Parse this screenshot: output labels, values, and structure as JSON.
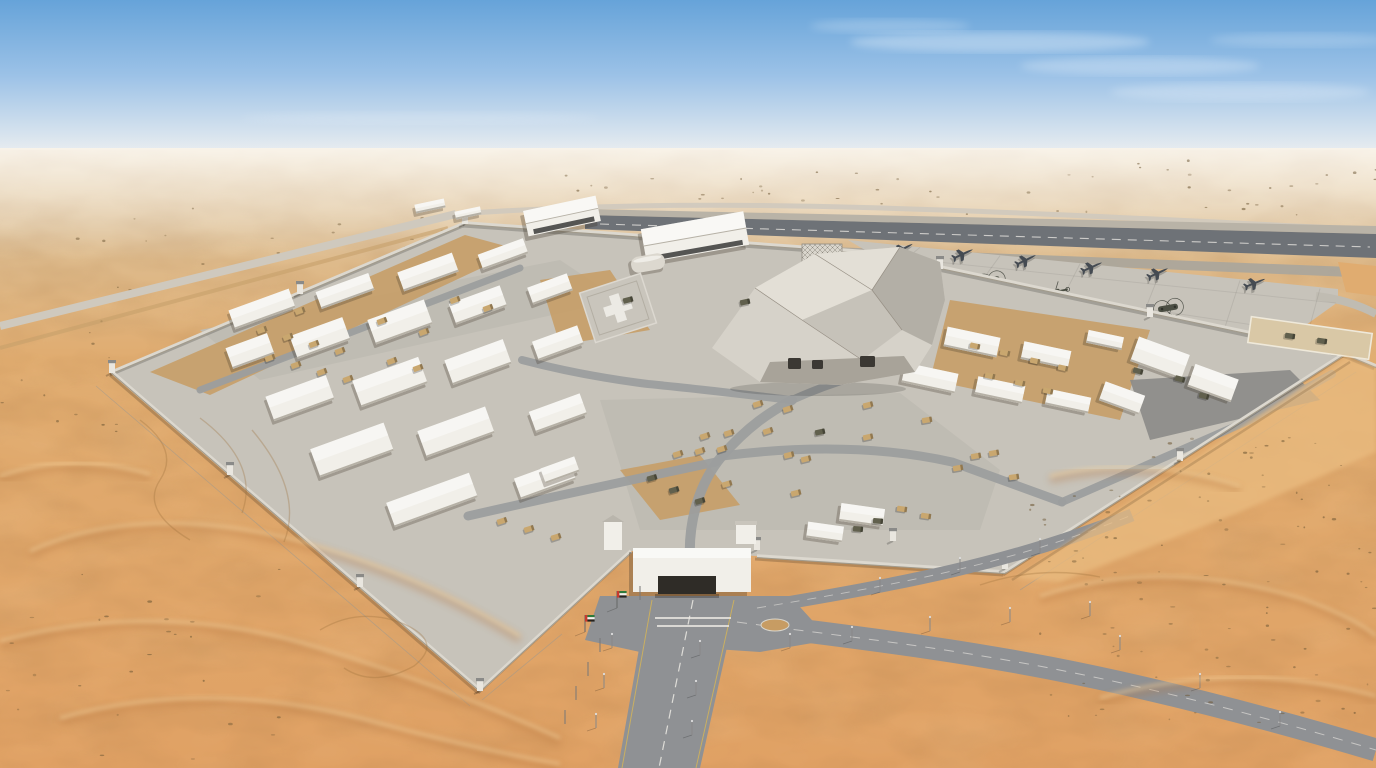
{
  "meta": {
    "title": "Aerial photograph of a walled military base with airstrip in a sand-dune desert",
    "time_of_day": "midday, hazy blue sky"
  },
  "palette": {
    "sky_top": "#66a3d9",
    "sky_mid": "#9cc2e7",
    "horizon_haze": "#e9edf0",
    "sand_far": "#ddc096",
    "sand_mid": "#e0ac70",
    "sand_near": "#e0a164",
    "dune_shadow": "#b5763f",
    "dune_light": "#f4d6a2",
    "concrete": "#c7c3ba",
    "concrete_light": "#d6d2c9",
    "asphalt": "#8f9194",
    "asphalt_dark": "#7b7d80",
    "runway": "#6e7277",
    "road_light": "#cfc9be",
    "dirt": "#c6a06a",
    "shrub": "#6e5835",
    "building_white": "#f1efe9",
    "building_shade": "#b6b1a6",
    "roof": "#e3dfd6",
    "hangar_door": "#3a3a38",
    "wall": "#dcd8cf",
    "wall_shadow": "#a29b8c",
    "vehicle_tan": "#c9a76f",
    "vehicle_dark": "#61604d",
    "aircraft": "#454b52",
    "helicopter": "#4c4f44",
    "marking_white": "#eceae4",
    "marking_yellow": "#d8b654",
    "flag_red": "#c8392e",
    "flag_green": "#2d7a3a",
    "flag_black": "#26231f",
    "flag_white": "#f2f2f0"
  },
  "sky": {
    "horizon_y": 150,
    "clouds": [
      [
        1000,
        42,
        150,
        10,
        0.3
      ],
      [
        1140,
        66,
        120,
        9,
        0.25
      ],
      [
        890,
        26,
        80,
        7,
        0.2
      ],
      [
        1240,
        92,
        130,
        9,
        0.22
      ],
      [
        1300,
        40,
        90,
        7,
        0.18
      ],
      [
        420,
        118,
        180,
        6,
        0.12
      ]
    ]
  },
  "outer_roads": {
    "highway_near": "M0,326 L456,214",
    "highway_far": "M456,214 C700,197 900,206 1376,230",
    "dirt_track": "M0,348 L448,228",
    "south_road_poly": "648,598 738,598 700,768 618,768",
    "south_centerline": "M693,600 L659,768",
    "south_edge_left": "M652,600 L622,768",
    "south_edge_right": "M734,600 L696,768",
    "east_branch": "M737,622 C920,647 1060,656 1376,750",
    "ne_branch": "M757,608 C900,584 1010,564 1132,515"
  },
  "airside": {
    "runway_shoulder": "585,209 1376,226 1376,234 585,215",
    "runway": "585,215 1376,234 1376,258 585,229",
    "runway_centerline": "M600,224 L1370,247",
    "taxiway": "700,242 1376,268 1376,278 700,250",
    "apron": "848,240 1338,289 1338,302 1282,342 1100,302 940,267 870,253",
    "sand_wedge": "1338,262 1376,266 1376,296 1346,292",
    "taxi_curve": "M1316,296 Q1350,300 1376,314"
  },
  "compound": {
    "ground": "112,372 465,223 870,252 1345,353 1005,572 757,556 631,551 480,690",
    "wall_segments": [
      [
        112,
        372,
        465,
        223
      ],
      [
        465,
        223,
        870,
        252
      ],
      [
        870,
        252,
        1345,
        353
      ],
      [
        1345,
        353,
        1376,
        366
      ],
      [
        1345,
        353,
        1005,
        572
      ],
      [
        1005,
        572,
        757,
        556
      ],
      [
        631,
        551,
        480,
        690
      ],
      [
        480,
        690,
        112,
        372
      ]
    ],
    "towers": [
      [
        112,
        372
      ],
      [
        230,
        474
      ],
      [
        360,
        586
      ],
      [
        480,
        690
      ],
      [
        614,
        538
      ],
      [
        757,
        549
      ],
      [
        893,
        540
      ],
      [
        1005,
        568
      ],
      [
        1180,
        460
      ],
      [
        1340,
        350
      ],
      [
        1150,
        316
      ],
      [
        940,
        268
      ],
      [
        300,
        293
      ],
      [
        465,
        223
      ]
    ],
    "fences": [
      [
        96,
        386,
        470,
        706
      ],
      [
        482,
        700,
        562,
        634
      ],
      [
        1020,
        590,
        1356,
        372
      ]
    ],
    "sand_patches": [
      "950,300 1150,330 1120,420 930,380",
      "150,372 465,235 520,250 210,395",
      "540,280 610,270 650,330 560,345",
      "620,470 700,455 740,505 660,520"
    ],
    "paved_lots": [
      "600,400 900,393 1000,470 980,530 640,530",
      "200,330 560,260 620,300 260,380"
    ],
    "dark_lot": "1130,380 1290,370 1320,400 1150,440",
    "inner_roads": [
      {
        "d": "M690,560 C688,520 700,482 722,456 C748,426 770,412 792,400",
        "w": 10
      },
      {
        "d": "M716,462 C640,478 556,496 468,516",
        "w": 9
      },
      {
        "d": "M722,456 C800,446 880,446 952,462 L1062,502",
        "w": 9
      },
      {
        "d": "M792,400 C832,382 872,370 910,366",
        "w": 8
      },
      {
        "d": "M792,400 C740,394 690,388 648,384 C600,378 560,370 522,360",
        "w": 8
      },
      {
        "d": "M200,390 L520,268",
        "w": 7
      },
      {
        "d": "M1062,502 L1250,420 L1332,374",
        "w": 8
      }
    ]
  },
  "buildings": {
    "boxes": [
      [
        262,
        309,
        64,
        20,
        -20
      ],
      [
        345,
        291,
        56,
        18,
        -20
      ],
      [
        428,
        272,
        58,
        20,
        -20
      ],
      [
        503,
        254,
        48,
        16,
        -20
      ],
      [
        250,
        351,
        44,
        22,
        -20
      ],
      [
        320,
        338,
        56,
        24,
        -20
      ],
      [
        400,
        322,
        60,
        26,
        -20
      ],
      [
        478,
        305,
        54,
        22,
        -20
      ],
      [
        550,
        289,
        42,
        18,
        -20
      ],
      [
        300,
        398,
        64,
        26,
        -20
      ],
      [
        390,
        382,
        70,
        28,
        -20
      ],
      [
        478,
        362,
        62,
        26,
        -20
      ],
      [
        558,
        343,
        48,
        20,
        -20
      ],
      [
        352,
        450,
        78,
        30,
        -20
      ],
      [
        456,
        432,
        72,
        28,
        -20
      ],
      [
        558,
        413,
        54,
        22,
        -20
      ],
      [
        432,
        500,
        88,
        26,
        -20
      ],
      [
        545,
        479,
        58,
        22,
        -20
      ],
      [
        905,
        331,
        50,
        18,
        12
      ],
      [
        972,
        342,
        54,
        20,
        12
      ],
      [
        1046,
        355,
        48,
        18,
        12
      ],
      [
        930,
        378,
        54,
        20,
        12
      ],
      [
        1000,
        390,
        48,
        18,
        12
      ],
      [
        1068,
        401,
        44,
        16,
        12
      ],
      [
        1160,
        358,
        54,
        26,
        20
      ],
      [
        1213,
        383,
        46,
        24,
        20
      ],
      [
        1122,
        398,
        42,
        20,
        20
      ],
      [
        862,
        515,
        44,
        18,
        8
      ],
      [
        825,
        532,
        36,
        16,
        8
      ],
      [
        430,
        206,
        30,
        9,
        -12
      ],
      [
        468,
        213,
        26,
        8,
        -12
      ],
      [
        1105,
        340,
        36,
        13,
        12
      ],
      [
        560,
        470,
        36,
        16,
        -20
      ]
    ],
    "hangars": [
      [
        562,
        216,
        74,
        26,
        -12
      ],
      [
        695,
        237,
        104,
        34,
        -10
      ]
    ],
    "quonset": [
      648,
      263,
      34,
      16,
      -10
    ],
    "annex_yard": {
      "cx": 1310,
      "cy": 338,
      "w": 122,
      "h": 26,
      "r": 8
    },
    "helipad": {
      "cx": 618,
      "cy": 308,
      "w": 64,
      "h": 52,
      "r": -18,
      "marking_shape": "plus"
    },
    "radar": {
      "base": "795,302 806,268 840,268 852,302",
      "lattice": [
        802,
        244,
        40,
        30
      ]
    },
    "central": {
      "silhouette": "712,348 755,288 815,254 900,247 940,262 945,300 932,345 915,372 840,385 760,382",
      "facet_bright": "755,288 815,254 900,247 872,290 802,320",
      "facet_mid": "802,320 872,290 902,330 862,360",
      "facet_dark": "900,247 940,262 945,300 932,345 902,330 872,290",
      "facet_base": "760,382 840,385 915,372 904,356 770,362",
      "edges": "M755,288 L802,320 M815,254 L872,290 M900,247 L872,290 M872,290 L902,330 M802,320 L862,360",
      "openings": [
        [
          788,
          358,
          13,
          11
        ],
        [
          812,
          360,
          11,
          9
        ],
        [
          860,
          356,
          15,
          11
        ]
      ]
    },
    "gate": {
      "house": [
        633,
        548,
        118,
        44
      ],
      "bay": [
        658,
        576,
        58,
        18
      ],
      "left_tower": [
        604,
        522,
        18,
        28
      ],
      "right_hut": [
        736,
        524,
        20,
        20
      ],
      "plaza": "600,596 790,596 830,640 760,652 700,648 640,652 585,640",
      "island": [
        775,
        625,
        14,
        6
      ],
      "stop_bars": [
        "M655,618 L731,618",
        "M657,626 L729,626"
      ]
    }
  },
  "aircraft": {
    "jets": [
      [
        903,
        249,
        -28
      ],
      [
        963,
        254,
        -25
      ],
      [
        1026,
        260,
        -26
      ],
      [
        1092,
        267,
        -24
      ],
      [
        1158,
        273,
        -25
      ],
      [
        1255,
        283,
        -22
      ]
    ],
    "helicopters": [
      {
        "x": 838,
        "y": 263,
        "r": -25,
        "type": "blackhawk"
      },
      {
        "x": 1055,
        "y": 292,
        "r": -12,
        "type": "blackhawk"
      },
      {
        "x": 990,
        "y": 281,
        "r": -14,
        "type": "chinook"
      },
      {
        "x": 1168,
        "y": 308,
        "r": -10,
        "type": "chinook"
      }
    ]
  },
  "vehicles": {
    "tan": [
      [
        758,
        404,
        -18
      ],
      [
        788,
        409,
        -18
      ],
      [
        868,
        405,
        -14
      ],
      [
        705,
        436,
        -18
      ],
      [
        729,
        433,
        -18
      ],
      [
        768,
        431,
        -18
      ],
      [
        678,
        454,
        -18
      ],
      [
        700,
        451,
        -18
      ],
      [
        722,
        449,
        -18
      ],
      [
        789,
        455,
        -14
      ],
      [
        806,
        459,
        -14
      ],
      [
        727,
        484,
        -16
      ],
      [
        796,
        493,
        -14
      ],
      [
        868,
        437,
        -12
      ],
      [
        927,
        420,
        -10
      ],
      [
        958,
        468,
        -10
      ],
      [
        976,
        456,
        -10
      ],
      [
        994,
        453,
        -10
      ],
      [
        1014,
        477,
        -8
      ],
      [
        262,
        330,
        -20
      ],
      [
        288,
        337,
        -20
      ],
      [
        314,
        344,
        -20
      ],
      [
        340,
        351,
        -20
      ],
      [
        270,
        358,
        -20
      ],
      [
        296,
        365,
        -20
      ],
      [
        322,
        372,
        -20
      ],
      [
        348,
        379,
        -20
      ],
      [
        392,
        361,
        -20
      ],
      [
        418,
        368,
        -20
      ],
      [
        300,
        311,
        -20
      ],
      [
        382,
        321,
        -20
      ],
      [
        424,
        332,
        -20
      ],
      [
        975,
        346,
        12
      ],
      [
        1005,
        353,
        12
      ],
      [
        1035,
        361,
        12
      ],
      [
        1063,
        368,
        12
      ],
      [
        990,
        376,
        12
      ],
      [
        1020,
        383,
        12
      ],
      [
        1048,
        391,
        12
      ],
      [
        502,
        521,
        -18
      ],
      [
        529,
        529,
        -18
      ],
      [
        556,
        537,
        -18
      ],
      [
        902,
        509,
        8
      ],
      [
        926,
        516,
        8
      ],
      [
        455,
        300,
        -20
      ],
      [
        488,
        308,
        -20
      ]
    ],
    "dark": [
      [
        652,
        478,
        -16
      ],
      [
        674,
        490,
        -16
      ],
      [
        700,
        501,
        -16
      ],
      [
        820,
        432,
        -12
      ],
      [
        878,
        521,
        5
      ],
      [
        858,
        529,
        5
      ],
      [
        1138,
        371,
        15
      ],
      [
        1180,
        379,
        15
      ],
      [
        1204,
        396,
        15
      ],
      [
        745,
        302,
        -12
      ],
      [
        628,
        300,
        -15
      ],
      [
        1290,
        336,
        8
      ],
      [
        1322,
        341,
        8
      ]
    ]
  },
  "street_furniture": {
    "flags": [
      [
        617,
        608
      ],
      [
        585,
        632
      ]
    ],
    "bare_poles": [
      [
        640,
        600
      ],
      [
        600,
        652
      ],
      [
        588,
        676
      ],
      [
        576,
        700
      ],
      [
        565,
        724
      ]
    ],
    "light_poles": [
      [
        612,
        648
      ],
      [
        604,
        688
      ],
      [
        596,
        728
      ],
      [
        700,
        655
      ],
      [
        696,
        695
      ],
      [
        692,
        735
      ],
      [
        790,
        648
      ],
      [
        852,
        641
      ],
      [
        930,
        631
      ],
      [
        1010,
        622
      ],
      [
        1090,
        616
      ],
      [
        880,
        592
      ],
      [
        960,
        572
      ],
      [
        1040,
        553
      ],
      [
        1120,
        650
      ],
      [
        1200,
        688
      ],
      [
        1280,
        726
      ]
    ]
  },
  "desert": {
    "crest_paths": [
      "M30,555 Q140,505 300,545 Q420,578 520,640",
      "M0,645 Q160,602 320,652 Q450,692 560,742",
      "M60,722 Q200,682 360,722 Q470,752 560,768",
      "M1040,600 Q1160,560 1300,602 Q1356,622 1376,640",
      "M1100,702 Q1240,662 1376,700",
      "M1050,480 Q1140,458 1240,490",
      "M0,480 Q70,455 150,478"
    ],
    "east_drift": "M1352,360 L1376,368 L1376,452 L1240,512 L1060,582 L1016,578 L1348,356 Z",
    "drift_shadow": "M1012,580 L1350,362",
    "tracks": [
      "M140,420 q40,30 20,60 q-20,30 30,60",
      "M200,418 q60,45 42,95",
      "M252,430 q52,62 32,112",
      "M320,630 q40,-24 84,-6 q40,18 10,42 q-40,22 -70,2",
      "M980,585 q60,-20 120,-8"
    ],
    "shrub_regions_far": [
      {
        "x": 60,
        "y": 200,
        "w": 420,
        "h": 90,
        "n": 30,
        "s": 13
      },
      {
        "x": 560,
        "y": 165,
        "w": 380,
        "h": 45,
        "n": 22,
        "s": 17
      },
      {
        "x": 960,
        "y": 160,
        "w": 416,
        "h": 55,
        "n": 26,
        "s": 19
      },
      {
        "x": 0,
        "y": 320,
        "w": 120,
        "h": 120,
        "n": 12,
        "s": 23
      }
    ],
    "shrub_regions_near": [
      {
        "x": 1020,
        "y": 490,
        "w": 356,
        "h": 250,
        "n": 80,
        "s": 7
      },
      {
        "x": 1150,
        "y": 430,
        "w": 200,
        "h": 70,
        "n": 20,
        "s": 11
      },
      {
        "x": 0,
        "y": 560,
        "w": 280,
        "h": 200,
        "n": 26,
        "s": 5
      }
    ]
  }
}
